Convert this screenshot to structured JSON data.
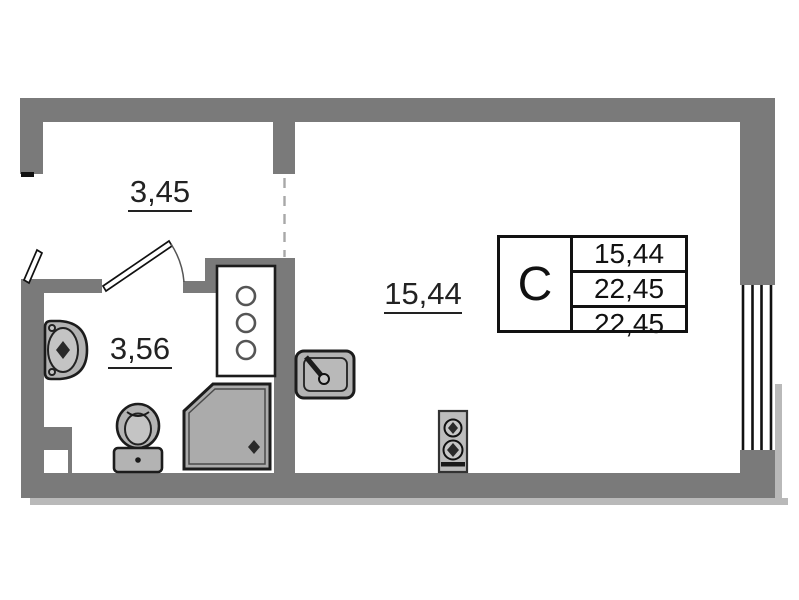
{
  "plan": {
    "rooms": [
      {
        "name": "hallway",
        "area_label": "3,45"
      },
      {
        "name": "bathroom",
        "area_label": "3,56"
      },
      {
        "name": "living-room",
        "area_label": "15,44"
      }
    ],
    "stamp": {
      "type_letter": "С",
      "rows": [
        "15,44",
        "22,45",
        "22,45"
      ]
    },
    "fixtures": [
      "wash-basin",
      "toilet",
      "shower-tray",
      "riser-shaft",
      "kitchen-sink",
      "stove",
      "window",
      "entrance-door-leaf",
      "bathroom-door-leaf"
    ],
    "colors": {
      "wall": "#7a7a7a",
      "wall_shadow": "#b9b9b9",
      "fixture_fill": "#b3b3b3",
      "fixture_fill_light": "#c4c4c4",
      "shower_fill": "#ababab",
      "outline": "#1c1c1c",
      "dashed_line": "#a8a8a8",
      "text": "#222222",
      "background": "#ffffff"
    }
  }
}
